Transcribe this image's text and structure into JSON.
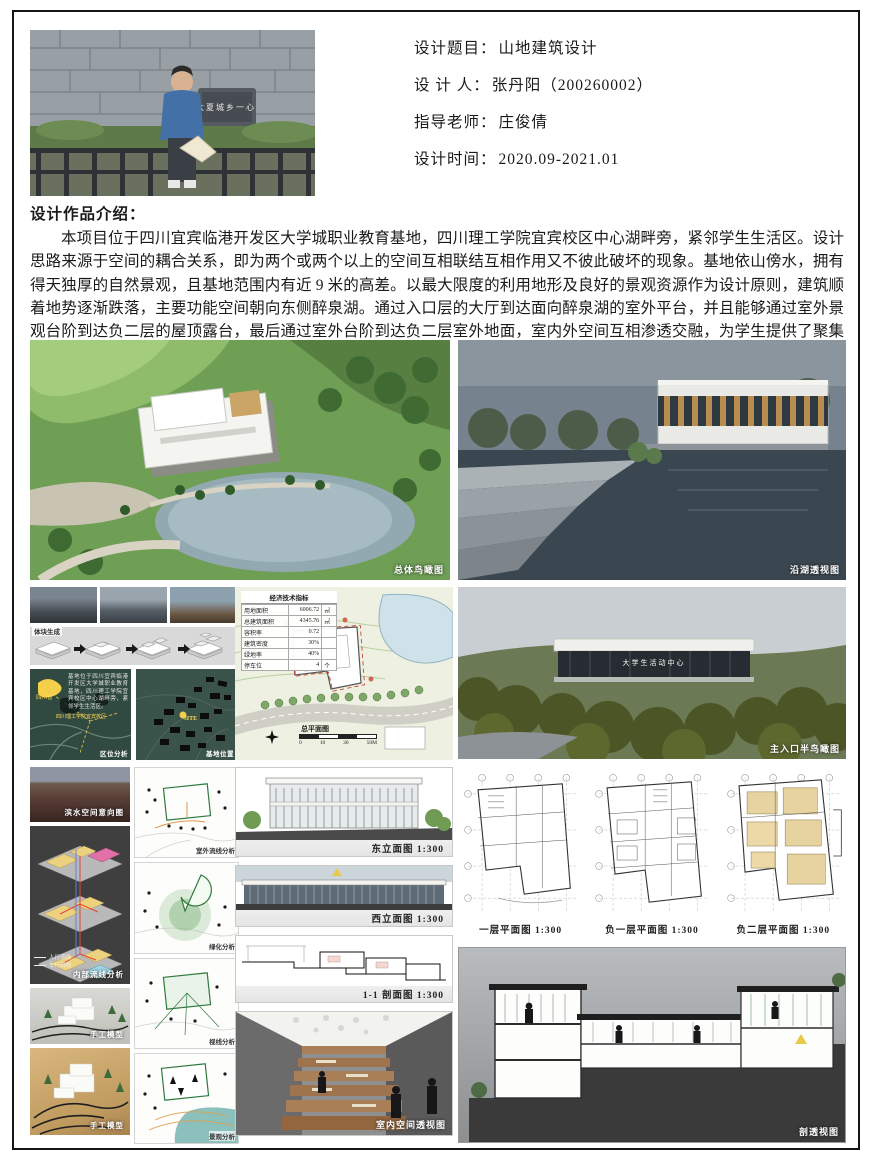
{
  "header": {
    "rows": [
      {
        "label": "设计题目：",
        "value": "山地建筑设计"
      },
      {
        "label": "设 计 人：",
        "value": "张丹阳（200260002）"
      },
      {
        "label": "指导老师：",
        "value": "庄俊倩"
      },
      {
        "label": "设计时间：",
        "value": "2020.09-2021.01"
      }
    ]
  },
  "intro": {
    "heading": "设计作品介绍：",
    "body": "本项目位于四川宜宾临港开发区大学城职业教育基地，四川理工学院宜宾校区中心湖畔旁，紧邻学生生活区。设计思路来源于空间的耦合关系，即为两个或两个以上的空间互相联结互相作用又不彼此破坏的现象。基地依山傍水，拥有得天独厚的自然景观，且基地范围内有近 9 米的高差。以最大限度的利用地形及良好的景观资源作为设计原则，建筑顺着地势逐渐跌落，主要功能空间朝向东侧醉泉湖。通过入口层的大厅到达面向醉泉湖的室外平台，并且能够通过室外景观台阶到达负二层的屋顶露台，最后通过室外台阶到达负二层室外地面，室内外空间互相渗透交融，为学生提供了聚集与交流的场所，也让人们可以全方位地漫游这座建筑。"
  },
  "renders": {
    "aerial_caption": "总体鸟瞰图",
    "lakeside_caption": "沿湖透视图",
    "entrance_caption": "主入口半鸟瞰图",
    "entrance_sign": "大学生活动中心",
    "interior_caption": "室内空间透视图",
    "section_persp_caption": "剖透视图"
  },
  "analysis": {
    "massing_label": "体块生成",
    "location_map": {
      "note": "基地位于四川宜宾临港开发区大学城职业教育基地，四川理工学院宜宾校区中心湖畔旁，紧邻学生生活区。",
      "province": "四川省",
      "campus": "四川理工学院宜宾校区",
      "caption": "区位分析"
    },
    "site_map": {
      "marker": "SITE",
      "caption": "基地位置"
    },
    "waterfront_caption": "滨水空间意向图",
    "axon": {
      "caption": "内部流线分析",
      "legend": [
        {
          "label": "人行流线"
        },
        {
          "label": "车行流线"
        }
      ]
    },
    "model_caption_1": "手工模型",
    "model_caption_2": "手工模型",
    "diagrams": [
      {
        "caption": "室外流线分析"
      },
      {
        "caption": "绿化分析"
      },
      {
        "caption": "视线分析"
      },
      {
        "caption": "景观分析"
      }
    ]
  },
  "site_plan": {
    "econ": {
      "title": "经济技术指标",
      "rows": [
        {
          "k": "用地面积",
          "v": "6006.72",
          "u": "㎡"
        },
        {
          "k": "总建筑面积",
          "v": "4345.76",
          "u": "㎡"
        },
        {
          "k": "容积率",
          "v": "0.72",
          "u": ""
        },
        {
          "k": "建筑密度",
          "v": "30%",
          "u": ""
        },
        {
          "k": "绿地率",
          "v": "40%",
          "u": ""
        },
        {
          "k": "停车位",
          "v": "4",
          "u": "个"
        }
      ]
    },
    "caption": "总平面图",
    "scale_ticks": [
      "0",
      "10",
      "30",
      "50M"
    ]
  },
  "drawings": {
    "east_elev": "东立面图 1:300",
    "west_elev": "西立面图 1:300",
    "section_11": "1-1 剖面图 1:300",
    "plan_l1": "一层平面图 1:300",
    "plan_b1": "负一层平面图 1:300",
    "plan_b2": "负二层平面图 1:300"
  }
}
